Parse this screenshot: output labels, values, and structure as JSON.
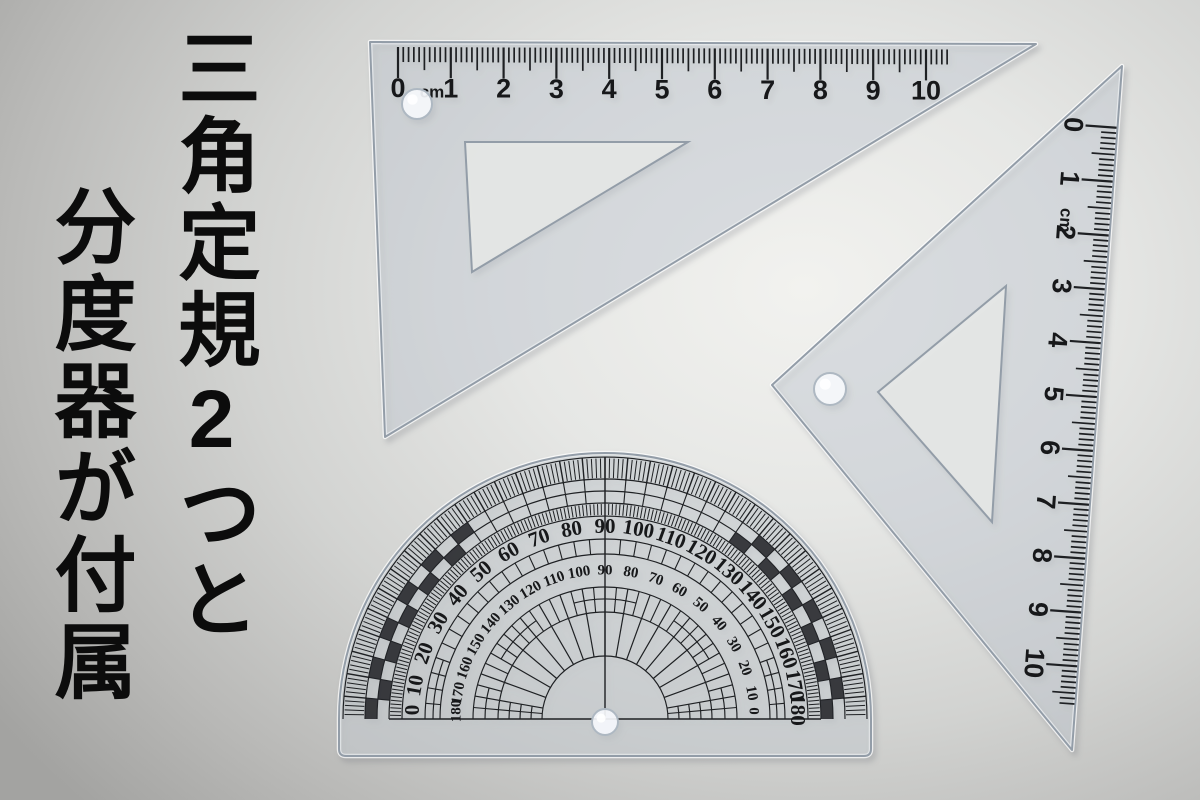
{
  "caption": {
    "line1": "三角定規2つと",
    "line2": "分度器が付属"
  },
  "triangle_ruler_top": {
    "unit": "cm",
    "labels": [
      "0",
      "1",
      "2",
      "3",
      "4",
      "5",
      "6",
      "7",
      "8",
      "9",
      "10"
    ]
  },
  "triangle_ruler_right": {
    "unit": "cm",
    "labels": [
      "0",
      "1",
      "2",
      "3",
      "4",
      "5",
      "6",
      "7",
      "8",
      "9",
      "10"
    ]
  },
  "protractor": {
    "outer_scale_labels": [
      "0",
      "10",
      "20",
      "30",
      "40",
      "50",
      "60",
      "70",
      "80",
      "90",
      "100",
      "110",
      "120",
      "130",
      "140",
      "150",
      "160",
      "170",
      "180"
    ],
    "inner_scale_labels": [
      "180",
      "170",
      "160",
      "150",
      "140",
      "130",
      "120",
      "110",
      "100",
      "90",
      "80",
      "70",
      "60",
      "50",
      "40",
      "30",
      "20",
      "10",
      "0"
    ]
  },
  "colors": {
    "ink": "#1e2023",
    "plastic_edge": "#939da8",
    "plastic_fill": "rgba(206,214,222,0.38)",
    "protractor_fill": "rgba(210,216,220,0.5)",
    "cutout_fill": "rgba(231,232,231,0.88)",
    "hole_fill": "rgba(246,249,252,0.92)",
    "hole_stroke": "#aeb8c2",
    "caption_ink": "#0c0c0c"
  }
}
